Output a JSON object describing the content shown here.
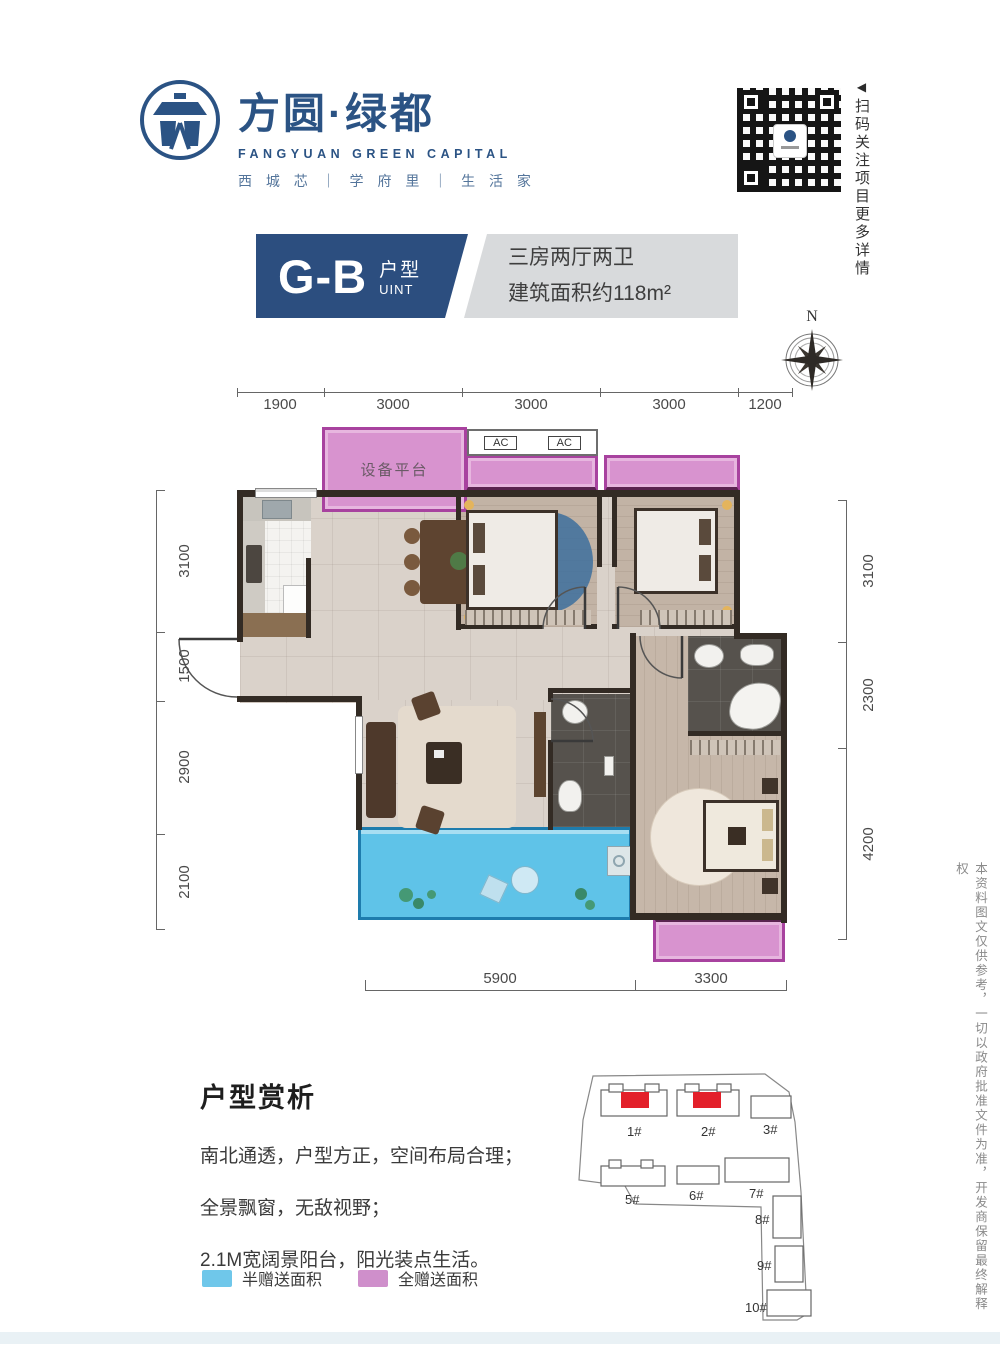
{
  "brand": {
    "name_cn": "方圆·绿都",
    "name_en": "FANGYUAN GREEN CAPITAL",
    "tagline": "西 城 芯 ｜ 学 府 里 ｜ 生 活 家"
  },
  "qr": {
    "caption": "扫码关注项目更多详情",
    "arrow": "◀"
  },
  "unit_header": {
    "code": "G-B",
    "type_label": "户型",
    "uint_label": "UINT",
    "desc_line1": "三房两厅两卫",
    "desc_line2": "建筑面积约118m²"
  },
  "compass": {
    "label": "N"
  },
  "plan": {
    "labels": {
      "equipment_platform": "设备平台",
      "ac": "AC"
    },
    "dims_top": [
      "1900",
      "3000",
      "3000",
      "3000",
      "1200"
    ],
    "dims_left": [
      "3100",
      "1500",
      "2900",
      "2100"
    ],
    "dims_right": [
      "3100",
      "2300",
      "4200"
    ],
    "dims_bottom": [
      "5900",
      "3300"
    ]
  },
  "analysis": {
    "title": "户型赏析",
    "line1": "南北通透，户型方正，空间布局合理；",
    "line2": "全景飘窗，无敌视野；",
    "line3": "2.1M宽阔景阳台，阳光装点生活。"
  },
  "legend": [
    {
      "label": "半赠送面积",
      "color": "#6FC7EA"
    },
    {
      "label": "全赠送面积",
      "color": "#CF8FCB"
    }
  ],
  "siteplan": {
    "buildings": [
      "1#",
      "2#",
      "3#",
      "5#",
      "6#",
      "7#",
      "8#",
      "9#",
      "10#"
    ],
    "highlight_color": "#E3202A"
  },
  "disclaimer": "本资料图文仅供参考，一切以政府批准文件为准，开发商保留最终解释权",
  "colors": {
    "brand_blue": "#2B5384",
    "header_blue": "#2C4E7F",
    "header_gray": "#D8DADC",
    "gift_half_blue": "#5FC3E8",
    "gift_full_pink": "#D893CF",
    "wall_dark": "#332B24",
    "site_red": "#E3202A"
  }
}
